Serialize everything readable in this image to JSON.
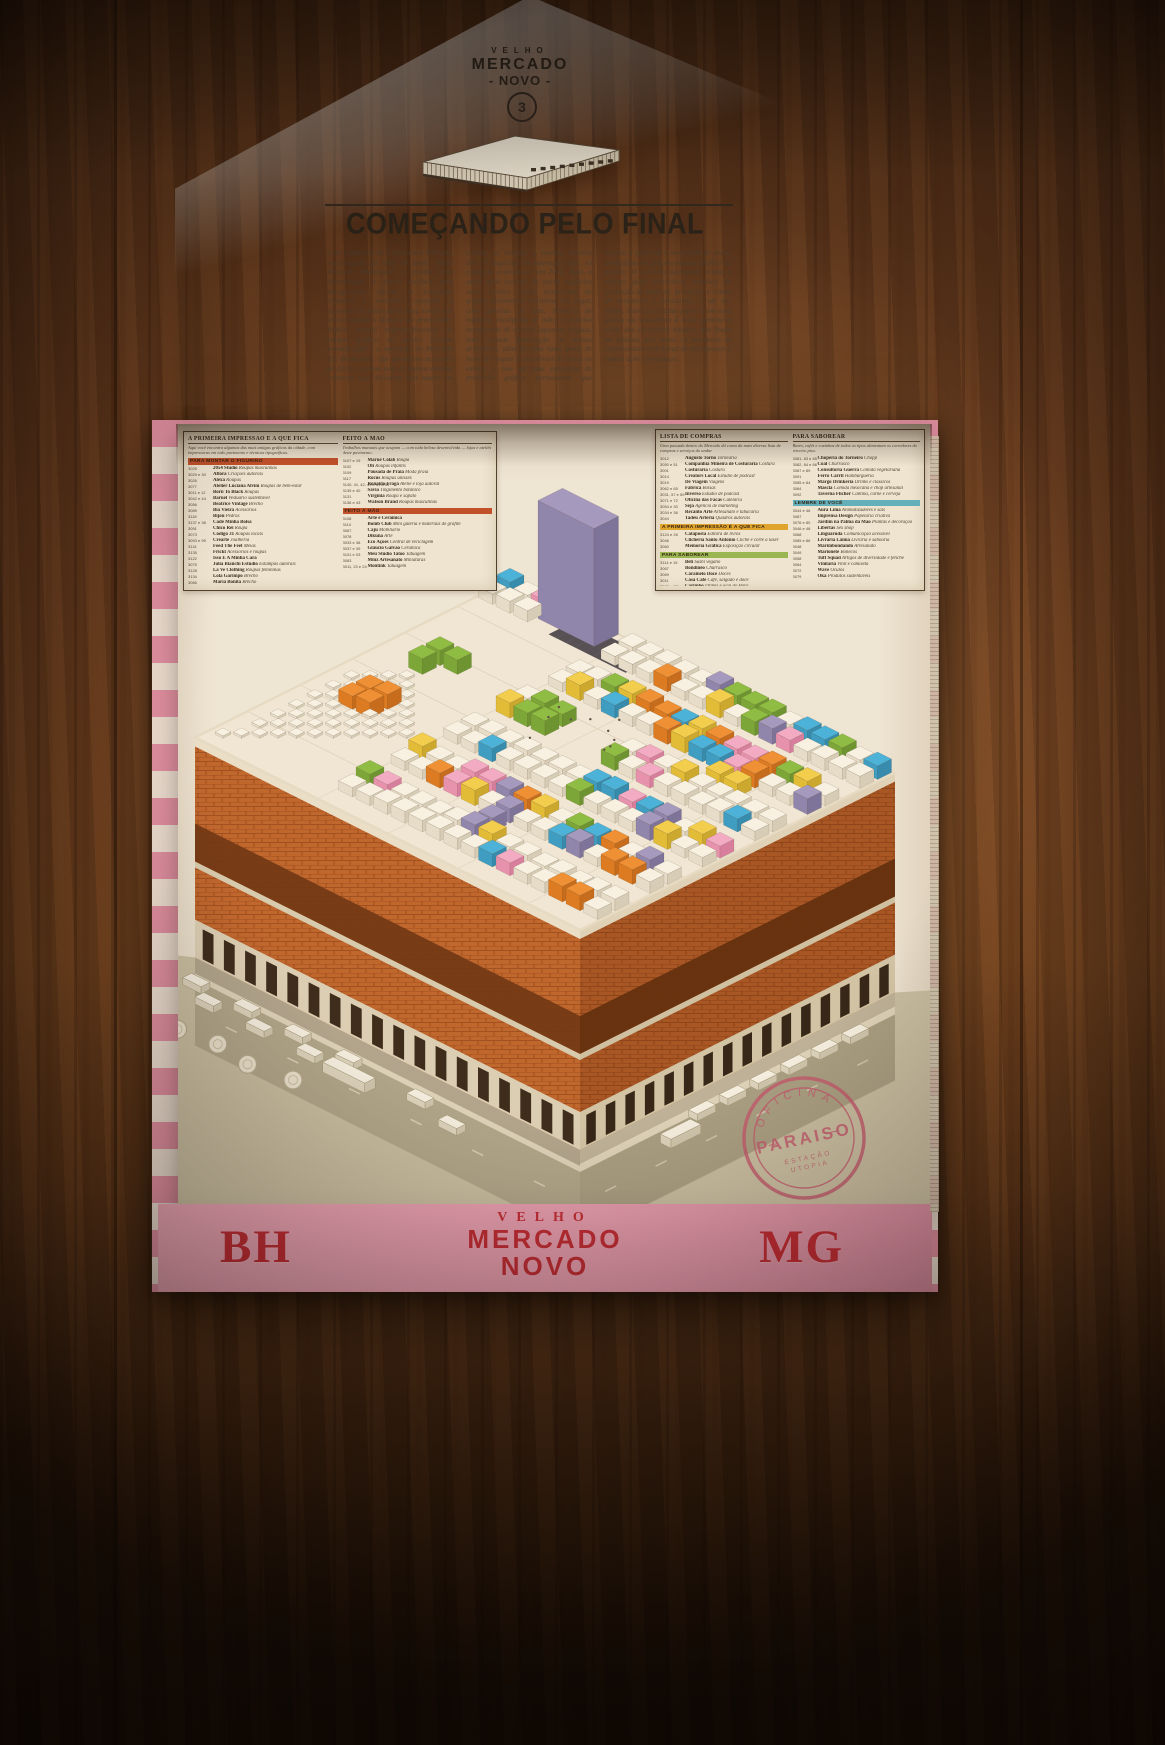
{
  "masthead": {
    "top": "VELHO",
    "name": "MERCADO",
    "sub": "- NOVO -",
    "issue": "3"
  },
  "headline": "COMEÇANDO PELO FINAL",
  "article": {
    "columns": [
      "Com a falência da Construtora Sobrado, encarregada da obra do então \"Novo Mercado Municipal\", o prédio ficou abandonado e nunca recebeu uma inauguração oficial. A ocupação orgânica e posterior, começou a acontecer de baixo para cima, sendo este terceiro andar o último a ser preenchido. Alguns poucos empreendimentos do parque gráfico do prédio fizeram morada aqui e a operação do Mercado das Borboletas, que aconteceu nos anos de 2010, o tornou sede de muitos eventos",
      "culturais que deixaram sua marca na cidade, no entanto, a enorme maioria dos 77 negócios em operação hoje, só começou a acontecer em 2020. Aqui, a safra mais recente de novos negócios deste icônico prédio modernista de quatro pavimentos encontra seu lugar, com galerias de arte, bonecos de madeira esculpidos à mão, o famoso restaurante de comida japonesa vegana, uma grande fabricação de bolsas artesanais, além de uma vasta gama de lojas de roupas e acessórios de todos os estilos — tem até uma exposição",
      "de produção gráfica permanente que mostra a potência e variedade de peças produzidas no próprio parque gráfico do prédio. O terceiro pavimento ainda é espaço para escritórios, estúdios de gravação de podcast, produção e venda de cerâmicas e miniaturas, e até sex shops. Subir as escadas para cá em uma quinta ou sexta-feira à noite garante a visão dos corredores lotados. Aos finais de semana, por vezes, os passantes se surpreendem com feiras de artesanatos e outras ações no espaço."
    ]
  },
  "directory": {
    "left_box": {
      "columns": [
        {
          "header": "A PRIMEIRA IMPRESSÃO É A QUE FICA",
          "intro": "Aqui você encontra algumas das mais antigas gráficas da cidade, com impressoras em todo pavimento e técnicas tipográficas.",
          "groups": [
            {
              "banner": "PARA MONTAR O FIGURINO",
              "color": "#c14f2a",
              "items": [
                {
                  "n": "3025",
                  "name": "2054 Studio",
                  "desc": "Roupas masculinas"
                },
                {
                  "n": "3029 e 30",
                  "name": "Aflora",
                  "desc": "Criações autorais"
                },
                {
                  "n": "3026",
                  "name": "Alexa",
                  "desc": "Roupas"
                },
                {
                  "n": "3077",
                  "name": "Atelier Luciana Alvim",
                  "desc": "Roupas de bem-estar"
                },
                {
                  "n": "3011 e 12",
                  "name": "Born To Black",
                  "desc": "Roupas"
                },
                {
                  "n": "3042 e 44",
                  "name": "Baruel",
                  "desc": "Vestuário sustentável"
                },
                {
                  "n": "3056",
                  "name": "Beatrice Vintage",
                  "desc": "Brechó"
                },
                {
                  "n": "3089",
                  "name": "Bia Vieira",
                  "desc": "Acessórios"
                },
                {
                  "n": "3118",
                  "name": "Bijou",
                  "desc": "Pedras"
                },
                {
                  "n": "3137 e 38",
                  "name": "Cadê Minha Bolsa",
                  "desc": ""
                },
                {
                  "n": "3091",
                  "name": "Chico Rei",
                  "desc": "Roupa"
                },
                {
                  "n": "3073",
                  "name": "Código 31",
                  "desc": "Roupas locais"
                },
                {
                  "n": "3093 e 95",
                  "name": "Crearte",
                  "desc": "Joalheria"
                },
                {
                  "n": "3141",
                  "name": "Feed The Feet",
                  "desc": "Meias"
                },
                {
                  "n": "3135",
                  "name": "Frickt",
                  "desc": "Acessórios e roupas"
                },
                {
                  "n": "3122",
                  "name": "Isso É A Minha Cara",
                  "desc": ""
                },
                {
                  "n": "3075",
                  "name": "Julia Bianchi Estúdio",
                  "desc": "Estampas autorais"
                },
                {
                  "n": "3128",
                  "name": "La Ve Clothing",
                  "desc": "Roupas femininas"
                },
                {
                  "n": "3134",
                  "name": "Lola Garimpo",
                  "desc": "Brechó"
                },
                {
                  "n": "3066",
                  "name": "Maria Bonita",
                  "desc": "Brechó"
                }
              ]
            }
          ]
        },
        {
          "header": "FEITO À MÃO",
          "intro": "Trabalhos manuais que ocupam — com toda beleza desenvolvida — lojas e ateliês deste pavimento.",
          "groups": [
            {
              "banner": null,
              "color": null,
              "items": [
                {
                  "n": "3107 e 19",
                  "name": "Maruê Colab",
                  "desc": "Roupa"
                },
                {
                  "n": "3102",
                  "name": "Oli",
                  "desc": "Roupas infantis"
                },
                {
                  "n": "3109",
                  "name": "Pousada de Praia",
                  "desc": "Moda praia"
                },
                {
                  "n": "3117",
                  "name": "Rocus",
                  "desc": "Roupas unissex"
                },
                {
                  "n": "3140, 41, 42, 49 e 51 a 54",
                  "name": "Ronaldo Fraga",
                  "desc": "Ateliê e loja autoral"
                },
                {
                  "n": "3139 e 40",
                  "name": "Sávia",
                  "desc": "Tingimento botânico"
                },
                {
                  "n": "3131",
                  "name": "Virgínia",
                  "desc": "Roupa e sapato"
                },
                {
                  "n": "3136 e 43",
                  "name": "Watson Brand",
                  "desc": "Roupas masculinas"
                }
              ]
            },
            {
              "banner": "FEITO À MÃO",
              "color": "#c14f2a",
              "items": [
                {
                  "n": "3108",
                  "name": "Arte e Cerâmica",
                  "desc": ""
                },
                {
                  "n": "3110",
                  "name": "Bomb Club",
                  "desc": "Mini galeria e materiais de grafite"
                },
                {
                  "n": "3067",
                  "name": "Caju",
                  "desc": "Mobiliário"
                },
                {
                  "n": "3078",
                  "name": "Dikuna",
                  "desc": "Arte"
                },
                {
                  "n": "3033 e 38",
                  "name": "Eco Ações",
                  "desc": "Central de reciclagem"
                },
                {
                  "n": "3037 e 39",
                  "name": "Gláucio Galvão",
                  "desc": "Cerâmica"
                },
                {
                  "n": "3101 e 03",
                  "name": "Meu Studio Tatoo",
                  "desc": "Tatuagem"
                },
                {
                  "n": "3063",
                  "name": "Mmz Artesanato",
                  "desc": "Miniaturas"
                },
                {
                  "n": "3011, 23 e 24",
                  "name": "Montink",
                  "desc": "Tatuagem"
                }
              ]
            }
          ]
        }
      ]
    },
    "right_box": {
      "columns": [
        {
          "header": "LISTA DE COMPRAS",
          "intro": "Uma passada dentro do Mercado dá conta da mais diversa lista de compras e serviços do andar.",
          "groups": [
            {
              "banner": null,
              "color": null,
              "items": [
                {
                  "n": "3012",
                  "name": "Augusto Torno",
                  "desc": "Tornearia"
                },
                {
                  "n": "3050 e 51",
                  "name": "Companhia Mineira de Costuraria",
                  "desc": "Costura"
                },
                {
                  "n": "3001",
                  "name": "Costuraria",
                  "desc": "Costura"
                },
                {
                  "n": "3014",
                  "name": "Creators Local",
                  "desc": "Estúdio de podcast"
                },
                {
                  "n": "3019",
                  "name": "De Viagem",
                  "desc": "Viagens"
                },
                {
                  "n": "3062 e 65",
                  "name": "Fábrica",
                  "desc": "Bolsas"
                },
                {
                  "n": "3031, 57 e 59",
                  "name": "Inverso",
                  "desc": "Estúdio de podcast"
                },
                {
                  "n": "3071 e 72",
                  "name": "Oficina das Facas",
                  "desc": "Cutelaria"
                },
                {
                  "n": "3054 e 30",
                  "name": "Seja",
                  "desc": "Agência de marketing"
                },
                {
                  "n": "3034 e 36",
                  "name": "Recanto Arte",
                  "desc": "Artesanato e tabacaria"
                },
                {
                  "n": "3044",
                  "name": "Tadeu Arteria",
                  "desc": "Quadros autorais"
                }
              ]
            },
            {
              "banner": "A PRIMEIRA IMPRESSÃO É A QUE FICA",
              "color": "#dfa62e",
              "items": [
                {
                  "n": "3124 e 26",
                  "name": "Cataposta",
                  "desc": "Editora de livros"
                },
                {
                  "n": "3046",
                  "name": "Clicheria Santo Antônio",
                  "desc": "Clichê e corte a laser"
                },
                {
                  "n": "3060",
                  "name": "Memória Gráfica",
                  "desc": "Exposição circular"
                }
              ]
            },
            {
              "banner": "PARA SABOREAR",
              "color": "#97b954",
              "items": [
                {
                  "n": "3114 e 15",
                  "name": "Beli",
                  "desc": "Sushi vegano"
                },
                {
                  "n": "3067",
                  "name": "Bondinêo",
                  "desc": "Churrasco"
                },
                {
                  "n": "3069",
                  "name": "Caramelo Doce",
                  "desc": "Doces"
                },
                {
                  "n": "3011",
                  "name": "Casa Café",
                  "desc": "Café, salgado e doce"
                },
                {
                  "n": "3005 e 07",
                  "name": "Carimbó",
                  "desc": "Drinks e açaí do Pará"
                },
                {
                  "n": "3081 e 86",
                  "name": "Cervejaria Rogon",
                  "desc": "Cerveja self service"
                }
              ]
            }
          ]
        },
        {
          "header": "PARA SABOREAR",
          "intro": "Bares, cafés e cozinhas de todos os tipos alimentam os corredores do terceiro piso.",
          "groups": [
            {
              "banner": null,
              "color": null,
              "items": [
                {
                  "n": "3081, 83 e 85",
                  "name": "Choperia do Torneiro",
                  "desc": "Chopp"
                },
                {
                  "n": "3082, 84 e 86",
                  "name": "Coal",
                  "desc": "Churrasco"
                },
                {
                  "n": "3087 e 89",
                  "name": "Consultoria Guerra",
                  "desc": "Comida vegetariana"
                },
                {
                  "n": "3091",
                  "name": "Ferro Carril",
                  "desc": "Hamburgueria"
                },
                {
                  "n": "3085 e 84",
                  "name": "Margô Drinkeria",
                  "desc": "Drinks e clássicos"
                },
                {
                  "n": "3084",
                  "name": "Mascla",
                  "desc": "Comida mexicana e chop artesanal"
                },
                {
                  "n": "3092",
                  "name": "Taverna Flicher",
                  "desc": "Cantina, carne e cerveja"
                }
              ]
            },
            {
              "banner": "LEMBRE DE VOCÊ",
              "color": "#5fb3c2",
              "items": [
                {
                  "n": "3044 e 46",
                  "name": "Aura Lima",
                  "desc": "Aromatizadores e sais"
                },
                {
                  "n": "3087",
                  "name": "Imprensa Design",
                  "desc": "Papelaria criativa"
                },
                {
                  "n": "3076 e 80",
                  "name": "Jardim na Palma da Mão",
                  "desc": "Plantas e decoração"
                },
                {
                  "n": "3046 e 48",
                  "name": "Libertas",
                  "desc": "Sex shop"
                },
                {
                  "n": "3068",
                  "name": "Linguaruda",
                  "desc": "Comunicação acessível"
                },
                {
                  "n": "3085 e 86",
                  "name": "Livraria Lâmia",
                  "desc": "Livraria e saboaria"
                },
                {
                  "n": "3048",
                  "name": "Marimbondando",
                  "desc": "Artesanato"
                },
                {
                  "n": "3049",
                  "name": "Marionete",
                  "desc": "Bonecos"
                },
                {
                  "n": "3058",
                  "name": "Tuff Squad",
                  "desc": "Artigos de diversidade e fetiche"
                },
                {
                  "n": "3064",
                  "name": "Vinilaria",
                  "desc": "Vinil e camiseta"
                },
                {
                  "n": "3072",
                  "name": "Wave",
                  "desc": "Óculos"
                },
                {
                  "n": "3079",
                  "name": "Oka",
                  "desc": "Produtos sustentáveis"
                }
              ]
            }
          ]
        }
      ]
    }
  },
  "stamp": {
    "arc_top": "OFICINA",
    "center": "PARAISO",
    "line1": "ESTAÇÃO",
    "line2": "UTOPIA",
    "color": "#c25a70"
  },
  "band": {
    "left": "BH",
    "right": "MG",
    "center": [
      "VELHO",
      "MERCADO",
      "NOVO"
    ]
  },
  "palette": {
    "brick": "#c0662e",
    "brick_line": "#964719",
    "brick_dark_band": "#6e3513",
    "roof": "#f2ecdc",
    "ground": "#c9c1a6",
    "road": "#b0a88e",
    "sidewalk": "#ded6bf",
    "cube_white": [
      "#faf6ea",
      "#e8e1d0",
      "#d8d1bd"
    ],
    "cube_pink": [
      "#f4aecb",
      "#e993b4",
      "#d97fa3"
    ],
    "cube_blue": [
      "#45b5e2",
      "#389fc9",
      "#2f8cb3"
    ],
    "cube_green": [
      "#8cc043",
      "#79a93a",
      "#699633"
    ],
    "cube_orange": [
      "#f19136",
      "#dd7b22",
      "#c66c1c"
    ],
    "cube_yellow": [
      "#f5d24f",
      "#e3bf38",
      "#ccaa2e"
    ],
    "cube_purple": [
      "#a39cc6",
      "#8d86b2",
      "#7a739f"
    ],
    "car": [
      "#f7f3e7",
      "#ddd6c2",
      "#cfc8b2"
    ]
  }
}
